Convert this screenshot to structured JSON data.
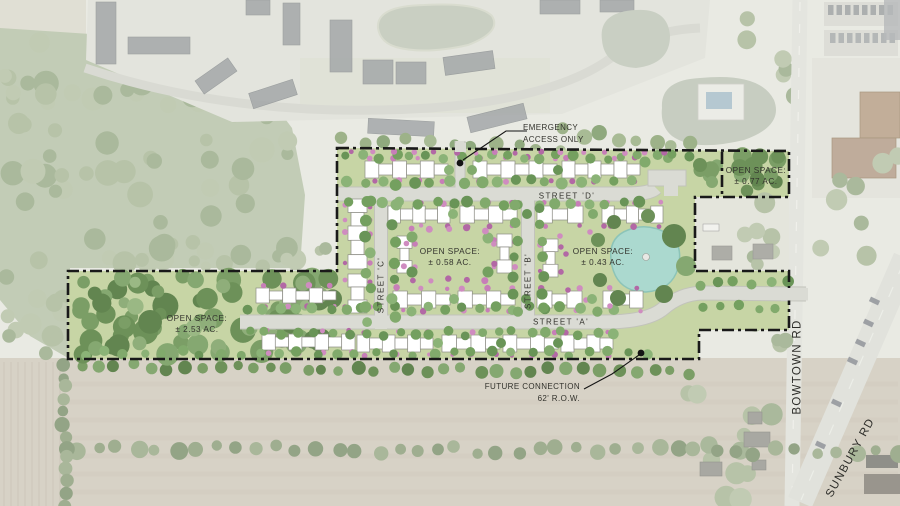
{
  "page": {
    "type": "residential-site-plan-aerial",
    "width": 900,
    "height": 506
  },
  "colors": {
    "aerial_base": "#e9eae3",
    "field_tan": "#d7d2c6",
    "site_lawn": "#c7d5a5",
    "site_road": "#dadbd4",
    "road_casing": "#c2c3bb",
    "tree_green": "#74a05f",
    "woods_green": "#6d9159",
    "bush_pink": "#c77eb8",
    "pond_teal": "#abd9cf",
    "building_white": "#ffffff",
    "boundary_black": "#191919"
  },
  "streets": [
    {
      "id": "street-d",
      "label": "STREET 'D'",
      "orientation": "horizontal"
    },
    {
      "id": "street-c",
      "label": "STREET 'C'",
      "orientation": "vertical"
    },
    {
      "id": "street-b",
      "label": "STREET 'B'",
      "orientation": "vertical"
    },
    {
      "id": "street-a",
      "label": "STREET 'A'",
      "orientation": "horizontal"
    }
  ],
  "open_spaces": [
    {
      "id": "open-space-north",
      "label": "OPEN SPACE:",
      "area": "± 0.77 AC."
    },
    {
      "id": "open-space-central",
      "label": "OPEN SPACE:",
      "area": "± 0.58 AC."
    },
    {
      "id": "open-space-pond",
      "label": "OPEN SPACE:",
      "area": "± 0.43 AC."
    },
    {
      "id": "open-space-west",
      "label": "OPEN SPACE:",
      "area": "± 2.53 AC."
    }
  ],
  "annotations": [
    {
      "id": "emergency-access",
      "line1": "EMERGENCY",
      "line2": "ACCESS ONLY"
    },
    {
      "id": "future-connection",
      "line1": "FUTURE CONNECTION",
      "line2": "62' R.O.W."
    }
  ],
  "external_roads": [
    {
      "id": "bowtown-rd",
      "label": "BOWTOWN RD"
    },
    {
      "id": "sunbury-rd",
      "label": "SUNBURY RD"
    }
  ]
}
